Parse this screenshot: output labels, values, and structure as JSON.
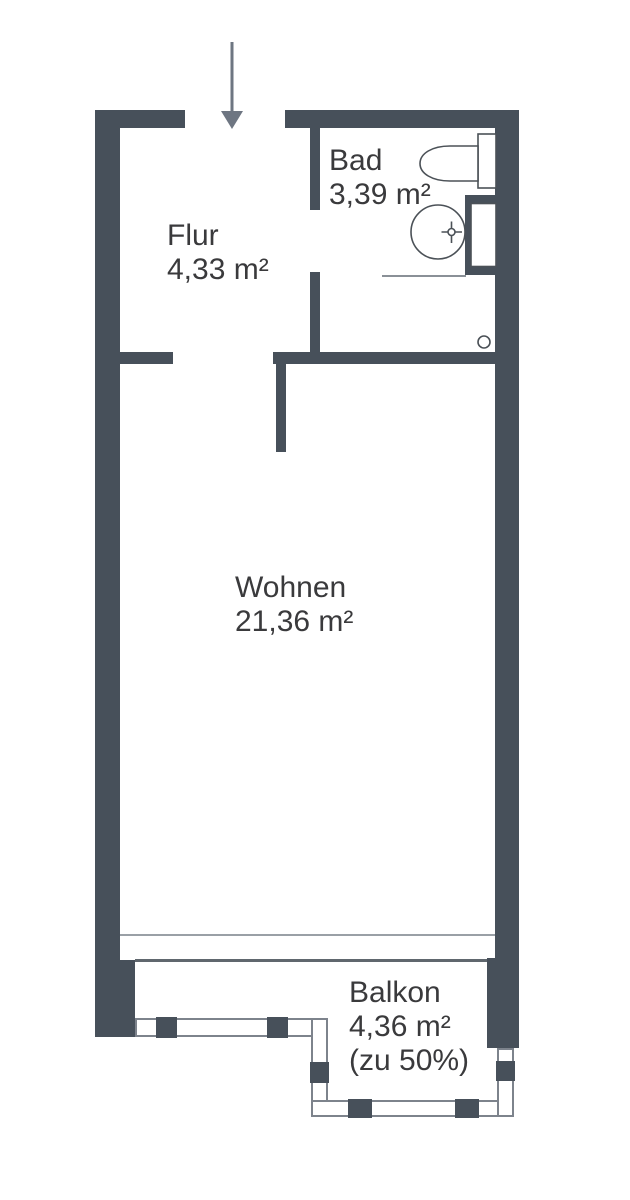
{
  "plan": {
    "type": "apartment-floor-plan",
    "entrance": {
      "symbol": "down-arrow",
      "direction": "down"
    },
    "rooms": {
      "flur": {
        "name": "Flur",
        "area": "4,33 m²"
      },
      "bad": {
        "name": "Bad",
        "area": "3,39 m²"
      },
      "wohnen": {
        "name": "Wohnen",
        "area": "21,36 m²"
      },
      "balkon": {
        "name": "Balkon",
        "area": "4,36 m²",
        "note": "(zu 50%)"
      }
    },
    "fixtures": [
      "toilet-icon",
      "sink-icon",
      "drain-icon",
      "duct-shaft"
    ],
    "colors": {
      "wall": "#47505a",
      "text": "#3a3a3c",
      "arrow": "#6e7682",
      "railing_outline": "#7d838c",
      "fixture_outline": "#4b5157",
      "window_sill_line": "#9aa0a6",
      "window_glass_line": "#60676e"
    }
  }
}
